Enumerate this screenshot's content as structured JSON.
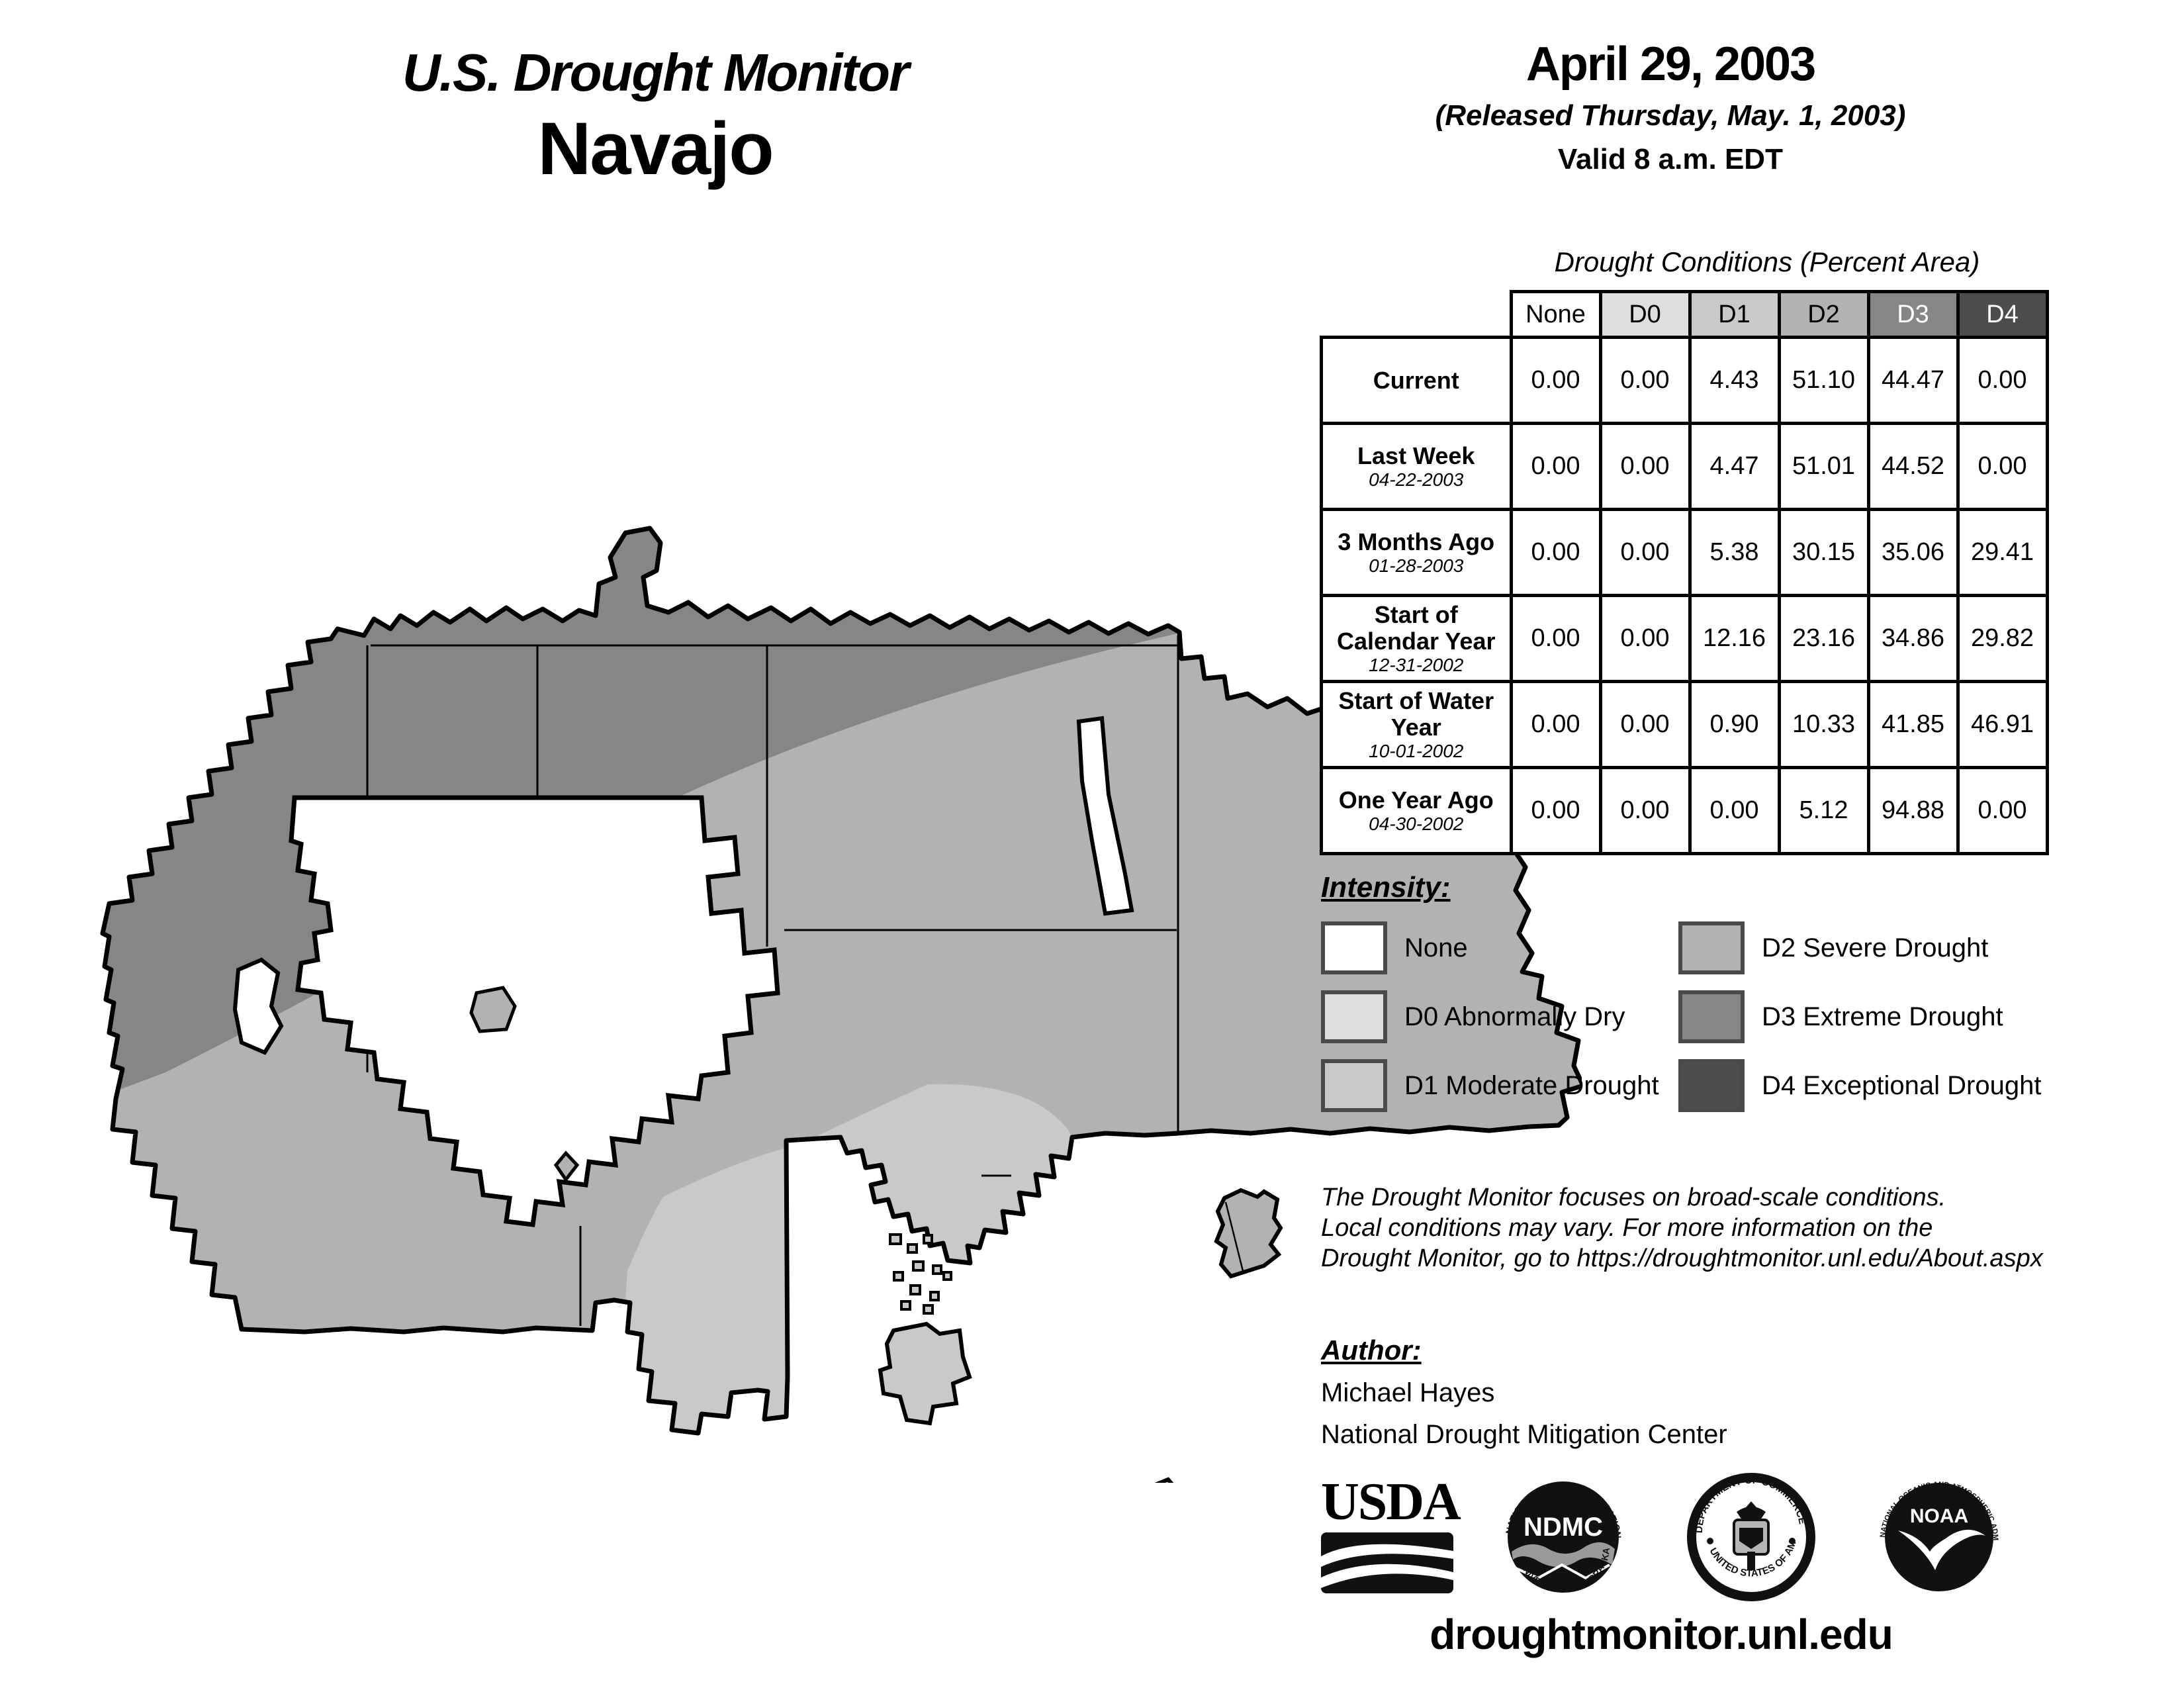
{
  "header": {
    "title_line1": "U.S. Drought Monitor",
    "title_line2": "Navajo",
    "date": "April 29, 2003",
    "released": "(Released Thursday, May. 1, 2003)",
    "valid": "Valid 8 a.m. EDT"
  },
  "table": {
    "title": "Drought Conditions (Percent Area)",
    "columns": [
      "None",
      "D0",
      "D1",
      "D2",
      "D3",
      "D4"
    ],
    "rows": [
      {
        "label": "Current",
        "date": "",
        "values": [
          "0.00",
          "0.00",
          "4.43",
          "51.10",
          "44.47",
          "0.00"
        ]
      },
      {
        "label": "Last Week",
        "date": "04-22-2003",
        "values": [
          "0.00",
          "0.00",
          "4.47",
          "51.01",
          "44.52",
          "0.00"
        ]
      },
      {
        "label": "3 Months Ago",
        "date": "01-28-2003",
        "values": [
          "0.00",
          "0.00",
          "5.38",
          "30.15",
          "35.06",
          "29.41"
        ]
      },
      {
        "label": "Start of Calendar Year",
        "date": "12-31-2002",
        "values": [
          "0.00",
          "0.00",
          "12.16",
          "23.16",
          "34.86",
          "29.82"
        ]
      },
      {
        "label": "Start of Water Year",
        "date": "10-01-2002",
        "values": [
          "0.00",
          "0.00",
          "0.90",
          "10.33",
          "41.85",
          "46.91"
        ]
      },
      {
        "label": "One Year Ago",
        "date": "04-30-2002",
        "values": [
          "0.00",
          "0.00",
          "0.00",
          "5.12",
          "94.88",
          "0.00"
        ]
      }
    ]
  },
  "legend": {
    "title": "Intensity:",
    "items": [
      {
        "label": "None"
      },
      {
        "label": "D0 Abnormally Dry"
      },
      {
        "label": "D1 Moderate Drought"
      },
      {
        "label": "D2 Severe Drought"
      },
      {
        "label": "D3 Extreme Drought"
      },
      {
        "label": "D4 Exceptional Drought"
      }
    ]
  },
  "disclaimer": {
    "line1": "The Drought Monitor focuses on broad-scale conditions.",
    "line2": "Local conditions may vary. For more information on the",
    "line3": "Drought Monitor, go to https://droughtmonitor.unl.edu/About.aspx"
  },
  "author": {
    "title": "Author:",
    "name": "Michael Hayes",
    "org": "National Drought Mitigation Center"
  },
  "logos": {
    "usda": "USDA",
    "ndmc": "NDMC",
    "ndmc_top": "NATIONAL DROUGHT MITIGATION CENTER",
    "ndmc_bottom": "UNIVERSITY OF NEBRASKA",
    "doc_top": "DEPARTMENT OF COMMERCE",
    "doc_bottom": "UNITED STATES OF AMERICA",
    "noaa": "NOAA",
    "noaa_top": "NATIONAL OCEANIC AND ATMOSPHERIC ADMINISTRATION",
    "noaa_bottom": "U.S. DEPARTMENT OF COMMERCE"
  },
  "footer": {
    "url": "droughtmonitor.unl.edu"
  },
  "colors": {
    "none": "#ffffff",
    "d0": "#dedede",
    "d1": "#c9c9c9",
    "d2": "#b2b2b2",
    "d3": "#868686",
    "d4": "#4d4d4d",
    "outline": "#000000"
  }
}
